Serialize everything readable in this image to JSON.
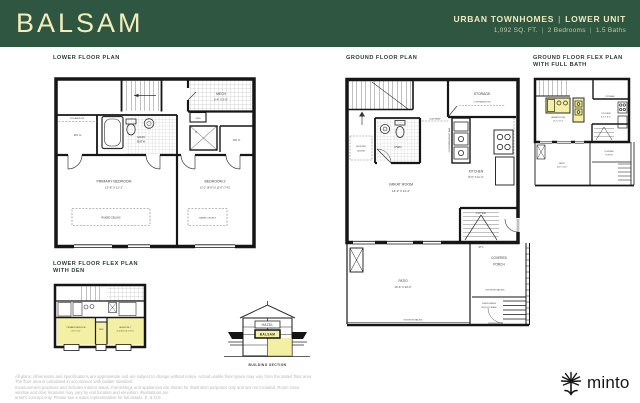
{
  "header": {
    "plan_name": "BALSAM",
    "collection": "URBAN TOWNHOMES",
    "unit": "LOWER UNIT",
    "sep": "|",
    "sqft": "1,092 SQ. FT.",
    "bedrooms": "2 Bedrooms",
    "baths": "1.5 Baths"
  },
  "lower": {
    "title": "LOWER FLOOR PLAN",
    "primary_name": "PRIMARY BEDROOM",
    "primary_dims": "13'-8\" X 11'-1\"",
    "bedroom2_name": "BEDROOM 2",
    "bedroom2_dims": "12'-2\" (8'-8\") X 11'-0\" (7'-6\")",
    "wic": "W.I.C.",
    "main_bath_l1": "MAIN",
    "main_bath_l2": "BATH",
    "mech": "MECH",
    "mech_dims": "6'-4\" X 5'-0\"",
    "linen": "LINEN",
    "dryer": "D",
    "low_headroom": "LOW HEADROOM",
    "raised_ceiling": "RAISED CEILING"
  },
  "ground": {
    "title": "GROUND FLOOR PLAN",
    "storage": "STORAGE",
    "low_headroom": "LOW HEADROOM",
    "pwd": "PWD",
    "dropped_l1": "DROPPED",
    "dropped_l2": "CEILING",
    "bulkhead": "BULKHEAD",
    "breakfast_bar": "FLUSH BREAKFAST BAR",
    "kitchen": "KITCHEN",
    "kitchen_dims": "8'-6\" X 11'-4\"",
    "great_room": "GREAT ROOM",
    "great_room_dims": "14'-2\" X 11'-4\"",
    "foyer": "FOYER",
    "st1": "ST-1",
    "patio": "PATIO",
    "patio_dims": "16'-6\" X 10'-0\"",
    "covered_l1": "COVERED",
    "covered_l2": "PORCH",
    "exterior_railing": "EXTERIOR RAILING",
    "risers_l1": "RISERS WHERE",
    "risers_l2": "REQ'D BY GRADE"
  },
  "ground_flex": {
    "title_l1": "GROUND FLOOR FLEX PLAN",
    "title_l2": "WITH FULL BATH"
  },
  "lower_flex": {
    "title_l1": "LOWER FLOOR FLEX PLAN",
    "title_l2": "WITH DEN",
    "den": "DEN"
  },
  "section": {
    "upper": "HAZEL",
    "lower": "BALSAM",
    "caption": "BUILDING SECTION"
  },
  "footer": {
    "line1": "All plans, dimensions and specifications are approximate and are subject to change without notice. Actual usable floor space may vary from the stated floor area. The floor area is calculated in accordance with builder standard",
    "line2": "measurement practices and includes interior areas. Furnishings and appliances are shown for illustration purposes only and are not included. Room sizes, window and door locations may vary by unit location and elevation. Illustrations are",
    "line3": "artist's concept only. Please see a sales representative for full details. E. & O.E.",
    "brand": "minto"
  },
  "colors": {
    "header_bg": "#2F5640",
    "accent_text": "#F2EDBC",
    "highlight": "#F3EFA3",
    "wall": "#161616"
  }
}
